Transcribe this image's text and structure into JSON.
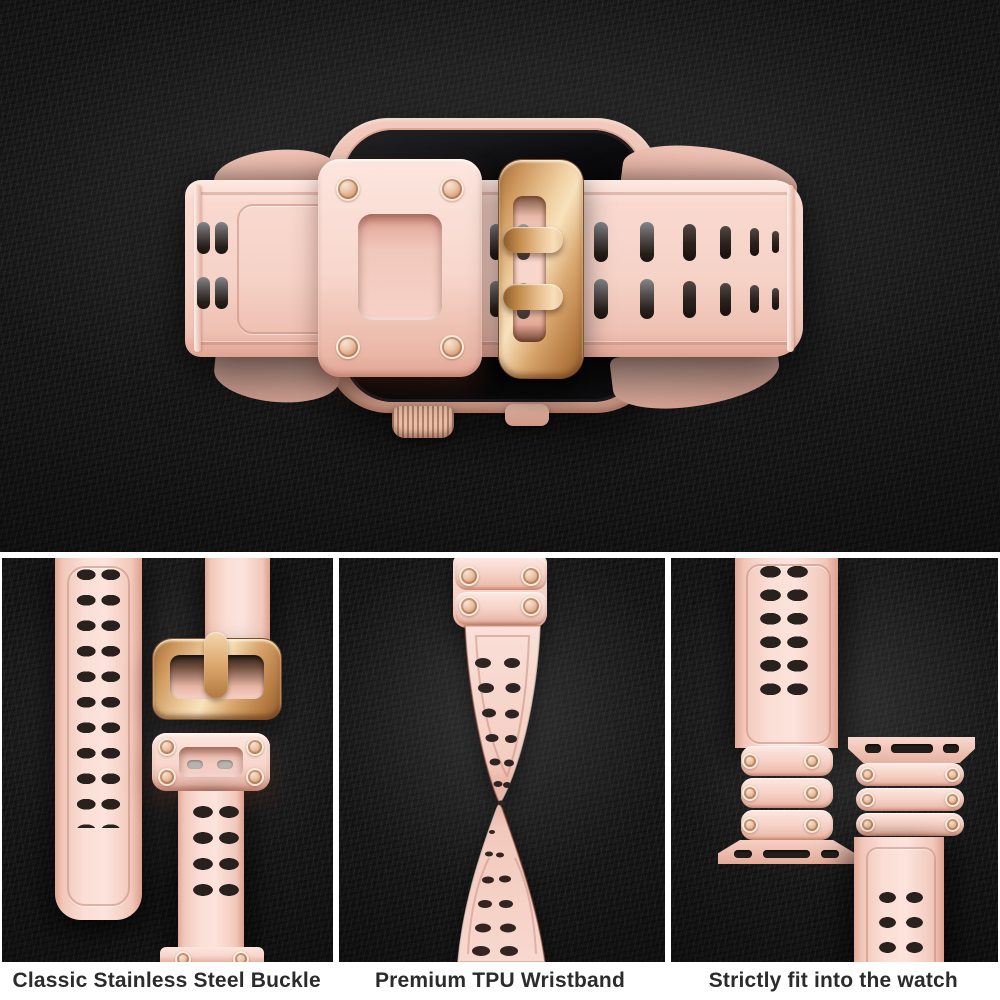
{
  "captions": {
    "panel1": "Classic Stainless Steel Buckle",
    "panel2": "Premium TPU Wristband",
    "panel3": "Strictly fit into the watch"
  },
  "colors": {
    "background_slate": "#141414",
    "band_pink": "#f7d4c9",
    "band_pink_deep": "#e0a392",
    "buckle_rose_gold": "#d8a36c",
    "watch_case_pink": "#edc3b6",
    "screen_black": "#0a0a0c",
    "hole_dark": "#2c231f",
    "frame_white": "#ffffff",
    "caption_text": "#2b2b2b"
  }
}
